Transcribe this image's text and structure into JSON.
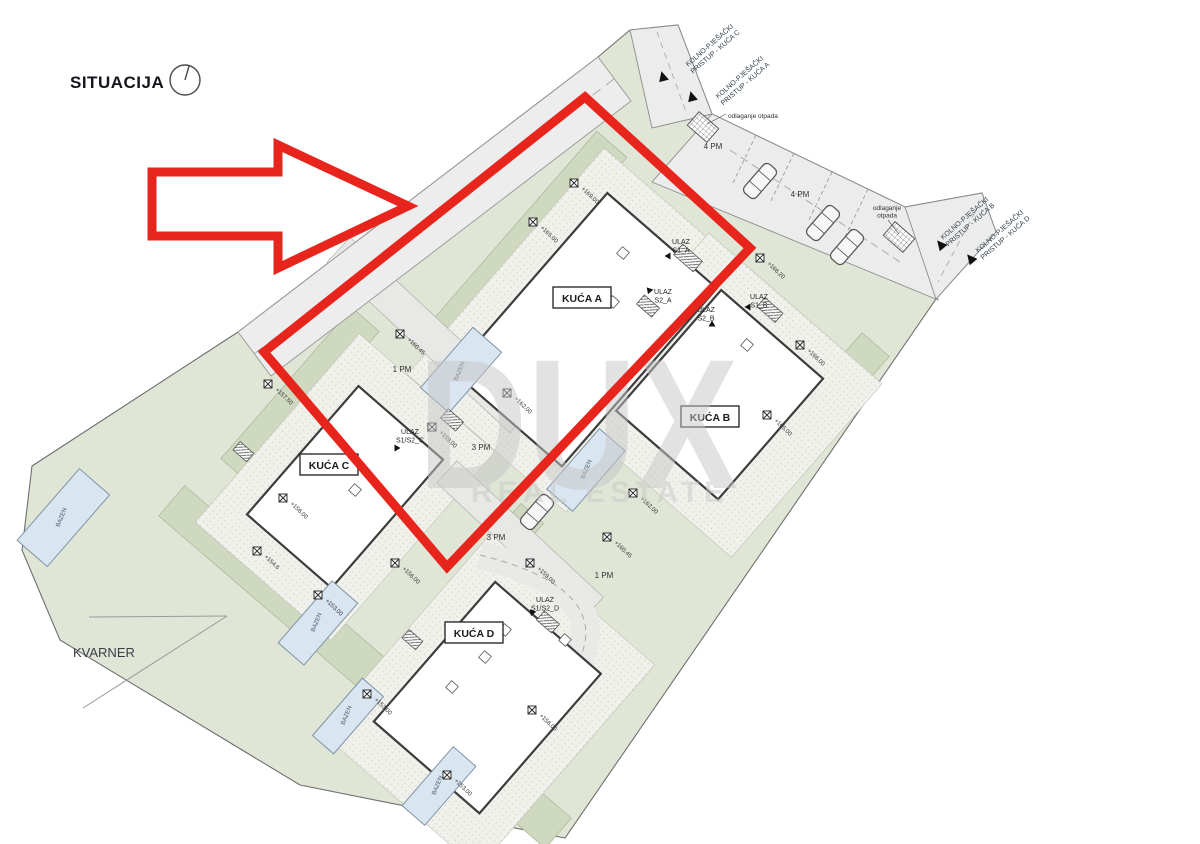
{
  "title": "SITUACIJA",
  "region_label": "KVARNER",
  "watermark": {
    "line1": "DUX",
    "line2": "REAL ESTATE"
  },
  "access_labels": [
    {
      "line1": "KOLNO-PJEŠAČKI",
      "line2": "PRISTUP - KUĆA C"
    },
    {
      "line1": "KOLNO-PJEŠAČKI",
      "line2": "PRISTUP - KUĆA A"
    },
    {
      "line1": "KOLNO-PJEŠAČKI",
      "line2": "PRISTUP - KUĆA B"
    },
    {
      "line1": "KOLNO-PJEŠAČKI",
      "line2": "PRISTUP - KUĆA D"
    }
  ],
  "houses": [
    {
      "label": "KUĆA A"
    },
    {
      "label": "KUĆA B"
    },
    {
      "label": "KUĆA C"
    },
    {
      "label": "KUĆA D"
    }
  ],
  "entrances": [
    {
      "line1": "ULAZ",
      "line2": "S1_A"
    },
    {
      "line1": "ULAZ",
      "line2": "S2_A"
    },
    {
      "line1": "ULAZ",
      "line2": "S2_B"
    },
    {
      "line1": "ULAZ",
      "line2": "S1_B"
    },
    {
      "line1": "ULAZ",
      "line2": "S1/S2_C"
    },
    {
      "line1": "ULAZ",
      "line2": "S1/S2_D"
    }
  ],
  "parking_labels": [
    "4 PM",
    "4 PM",
    "1 PM",
    "3 PM",
    "3 PM",
    "1 PM"
  ],
  "waste_label_1": "odlaganje otpada",
  "waste_label_2": {
    "line1": "odlaganje",
    "line2": "otpada"
  },
  "pool_label": "BAZEN",
  "elevations": [
    "+169.00",
    "+165.00",
    "+157.50",
    "+166.20",
    "+166.00",
    "+165.00",
    "+156.00",
    "+154.6",
    "+160.45",
    "+159.00",
    "+162.00",
    "+162.00",
    "+160.45",
    "+159.00",
    "+153.00",
    "+156.00",
    "+153.00",
    "+153.00",
    "+156.00"
  ],
  "colors": {
    "highlight_red": "#e8251d",
    "parcel_green": "#e0e6d6",
    "garden_green": "#cfd9bf",
    "road_gray": "#ececec",
    "pool_blue": "#d9e6f2",
    "watermark_gray": "#c6c6c6"
  }
}
